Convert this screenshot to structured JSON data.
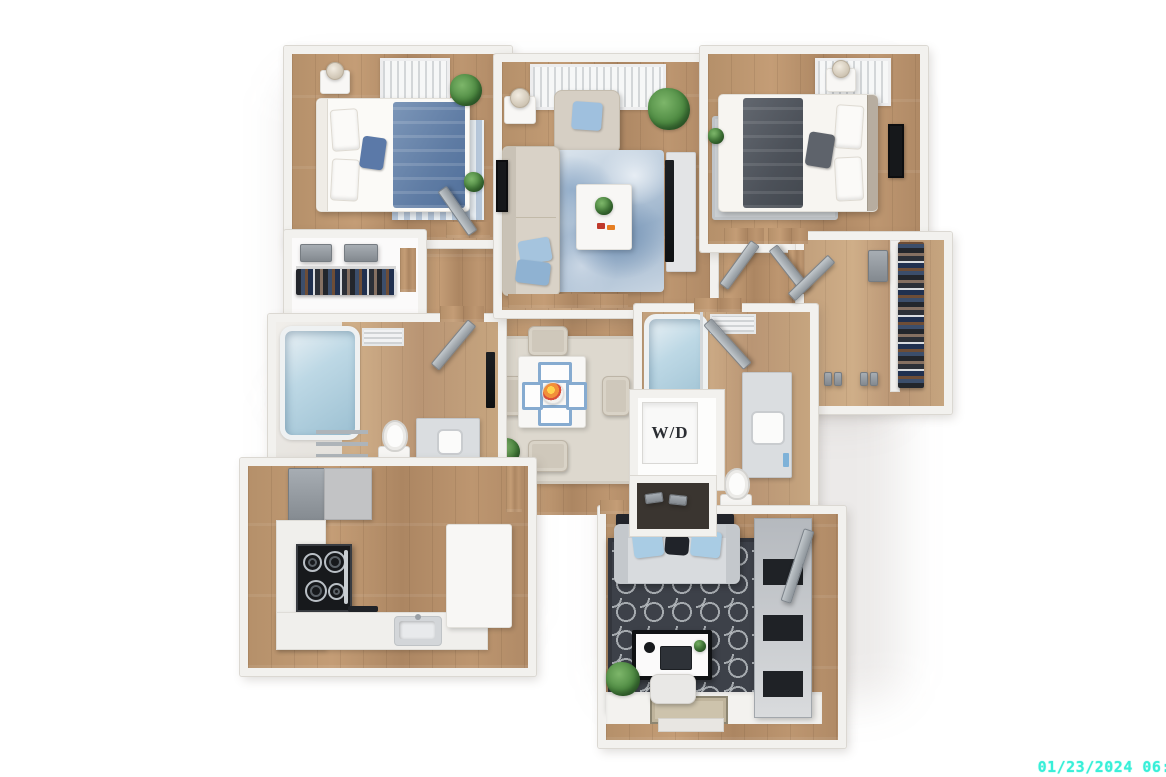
{
  "scene": {
    "type": "3D apartment floor plan, top-down render",
    "background_color": "#ffffff"
  },
  "labels": {
    "washer_dryer": "W/D"
  },
  "overlay": {
    "timestamp": "01/23/2024 06:",
    "timestamp_color": "#38efd8"
  },
  "palette": {
    "wood_floor": "#b8926c",
    "walls": "#f2f1ee",
    "accent_blue": "#86abd0",
    "bedding_blue": "#6d88ad",
    "bedding_gray": "#565b63",
    "rug_dark": "#3d4149",
    "plant_green": "#4e8a42"
  },
  "rooms": [
    {
      "name": "bedroom-1",
      "position": "top-left",
      "furniture": [
        "double-bed-blue-bedding",
        "nightstand-with-lamp",
        "plants",
        "striped-rug",
        "window-blinds"
      ]
    },
    {
      "name": "reach-in-closet",
      "position": "left",
      "furniture": [
        "hanging-clothes",
        "storage-boxes"
      ]
    },
    {
      "name": "bathroom-1",
      "position": "mid-left",
      "furniture": [
        "bathtub",
        "toilet",
        "vanity-sink",
        "towel-ladder",
        "ceiling-vent"
      ]
    },
    {
      "name": "living-room",
      "position": "top-center",
      "furniture": [
        "sofa",
        "armchair",
        "coffee-table",
        "marble-rug",
        "tv-console",
        "palm-plant",
        "floor-lamp",
        "window-blinds"
      ]
    },
    {
      "name": "bedroom-2",
      "position": "top-right",
      "furniture": [
        "double-bed-gray-bedding",
        "nightstand-with-lamp",
        "wall-art",
        "gray-rug",
        "window-blinds"
      ]
    },
    {
      "name": "walk-in-closet",
      "position": "right",
      "furniture": [
        "hanging-clothes",
        "shoes",
        "shelf"
      ]
    },
    {
      "name": "bathroom-2",
      "position": "center-right",
      "furniture": [
        "bathtub",
        "vanity-sink",
        "toilet",
        "washer-dryer-closet",
        "shoe-shelf",
        "ceiling-vent"
      ]
    },
    {
      "name": "dining-area",
      "position": "center",
      "furniture": [
        "square-table",
        "four-chairs",
        "blue-placemats",
        "fruit-bowl",
        "area-rug",
        "plant"
      ]
    },
    {
      "name": "kitchen",
      "position": "bottom-left",
      "furniture": [
        "refrigerator",
        "upper-cabinet",
        "stove-cooktop",
        "counters",
        "sink",
        "island"
      ]
    },
    {
      "name": "den-office",
      "position": "bottom-right",
      "furniture": [
        "loveseat",
        "trellis-rug",
        "desk",
        "laptop",
        "desk-chair",
        "storage-cabinet",
        "plant",
        "console-table"
      ]
    },
    {
      "name": "entry",
      "position": "bottom",
      "furniture": [
        "doormat",
        "entry-door"
      ]
    }
  ]
}
